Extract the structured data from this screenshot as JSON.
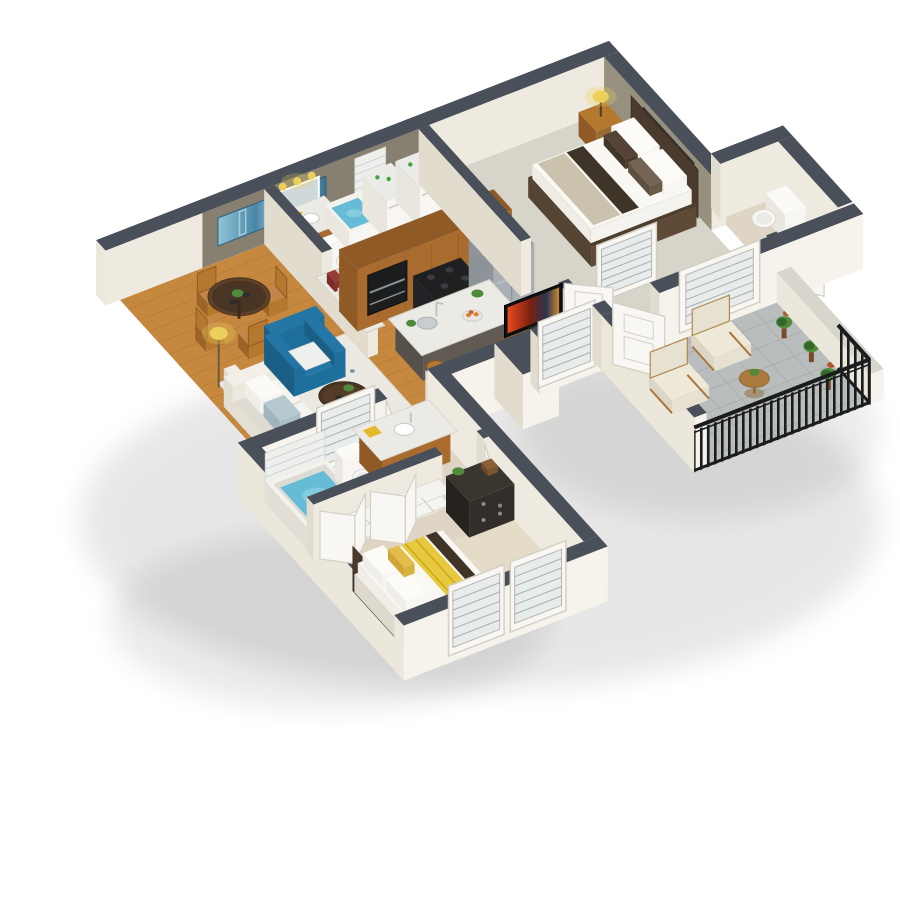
{
  "scene": {
    "label": "3D isometric floor plan rendering of a one-bedroom-plus-den apartment with sunroom balcony",
    "background": "#ffffff",
    "rooms": [
      {
        "name": "dining-area",
        "floor": "hardwood",
        "items": [
          "round-dining-table",
          "dining-chairs",
          "abstract-blue-painting",
          "pass-through-counter",
          "books"
        ]
      },
      {
        "name": "kitchen",
        "floor": "hardwood",
        "items": [
          "wood-cabinets",
          "wall-oven",
          "range-stove",
          "stainless-refrigerator",
          "marble-island",
          "sink-faucet",
          "bar-stools",
          "fruit-bowl"
        ]
      },
      {
        "name": "living-room",
        "floor": "hardwood",
        "items": [
          "white-sofa",
          "blue-armchair",
          "coffee-table",
          "area-rug",
          "floor-lamp",
          "tv-console",
          "television",
          "window-blinds"
        ]
      },
      {
        "name": "hall-bathroom",
        "floor": "tile",
        "items": [
          "vanity-mirror-lights",
          "toilet",
          "soaking-tub"
        ]
      },
      {
        "name": "laundry-closet",
        "floor": "tile",
        "items": [
          "washer",
          "dryer",
          "wire-shelving"
        ]
      },
      {
        "name": "master-bedroom",
        "floor": "carpet",
        "items": [
          "bed",
          "nightstand",
          "table-lamp",
          "black-white-artwork",
          "accent-wall",
          "blinds-window"
        ]
      },
      {
        "name": "master-bathroom",
        "floor": "tile",
        "items": [
          "toilet",
          "open-door"
        ]
      },
      {
        "name": "second-bathroom",
        "floor": "tile",
        "items": [
          "bathtub-blue-water",
          "white-brick-wall",
          "toilet",
          "wood-vanity-marble-top"
        ]
      },
      {
        "name": "walk-in-closets",
        "floor": "tile",
        "items": [
          "wire-shelves",
          "bifold-doors"
        ]
      },
      {
        "name": "second-bedroom",
        "floor": "carpet",
        "items": [
          "bed-yellow-runner",
          "black-dresser",
          "potted-plant",
          "framed-windows",
          "open-door"
        ]
      },
      {
        "name": "sunroom-patio",
        "floor": "gray-tile",
        "items": [
          "cream-armchair-1",
          "cream-armchair-2",
          "round-side-table",
          "potted-plants",
          "black-metal-railing"
        ]
      }
    ]
  },
  "palette": {
    "bg": "#ffffff",
    "capDark": "#4a505a",
    "wallSouth": "#efeadf",
    "wallWest": "#e2dccf",
    "wallOuterS": "#f6f3ec",
    "wallOuterW": "#ece7db",
    "accentOlive": "#878071",
    "accentTaupe": "#97907f",
    "floorWood": "#c6883f",
    "plankLine": "#8a5a23",
    "tileHall": "#ddd3c2",
    "carpetMaster": "#d7d4c9",
    "tileSun": "#b9bdbd",
    "groutSun": "#9aa0a0",
    "tileBath": "#ded5c5",
    "carpetBed2": "#e5dcc7",
    "marble": "#eceae4",
    "woodCab": "#a96c2e",
    "woodCabDark": "#8f5a26",
    "woodMid": "#9c6b35",
    "woodChair": "#b5782f",
    "furnDark": "#4a3423",
    "black": "#17181a",
    "charcoal": "#26272a",
    "stainless": "#a9afb4",
    "stainDark": "#8d9398",
    "white": "#f7f6f2",
    "whiteShade": "#e9e6de",
    "cream": "#e7e1d1",
    "blueChair": "#1f6f9c",
    "blueChairCap": "#2376a6",
    "blueChairDark": "#1b5f86",
    "yellow": "#ecd059",
    "yellowDeep": "#e3b92c",
    "runnerYellow": "#e8c93e",
    "waterBlue": "#66bcd6",
    "waterLight": "#9ad7e8",
    "brick": "#eef0ee",
    "brickLine": "#cdd2cd",
    "green": "#4e8a3a",
    "greenDark": "#33672a",
    "potBrown": "#7a4b28",
    "glass": "#e8ecec",
    "tvFrame": "#0f1012",
    "railDark": "#1b1c1e",
    "artDark": "#3a3a3c",
    "artLight": "#cfd0d2",
    "doorWhite": "#f8f7f3",
    "doorLine": "#d4d0c6",
    "mirror": "#cfd8da",
    "chrome": "#c0c4c8",
    "headboard": "#4a3b2e"
  }
}
